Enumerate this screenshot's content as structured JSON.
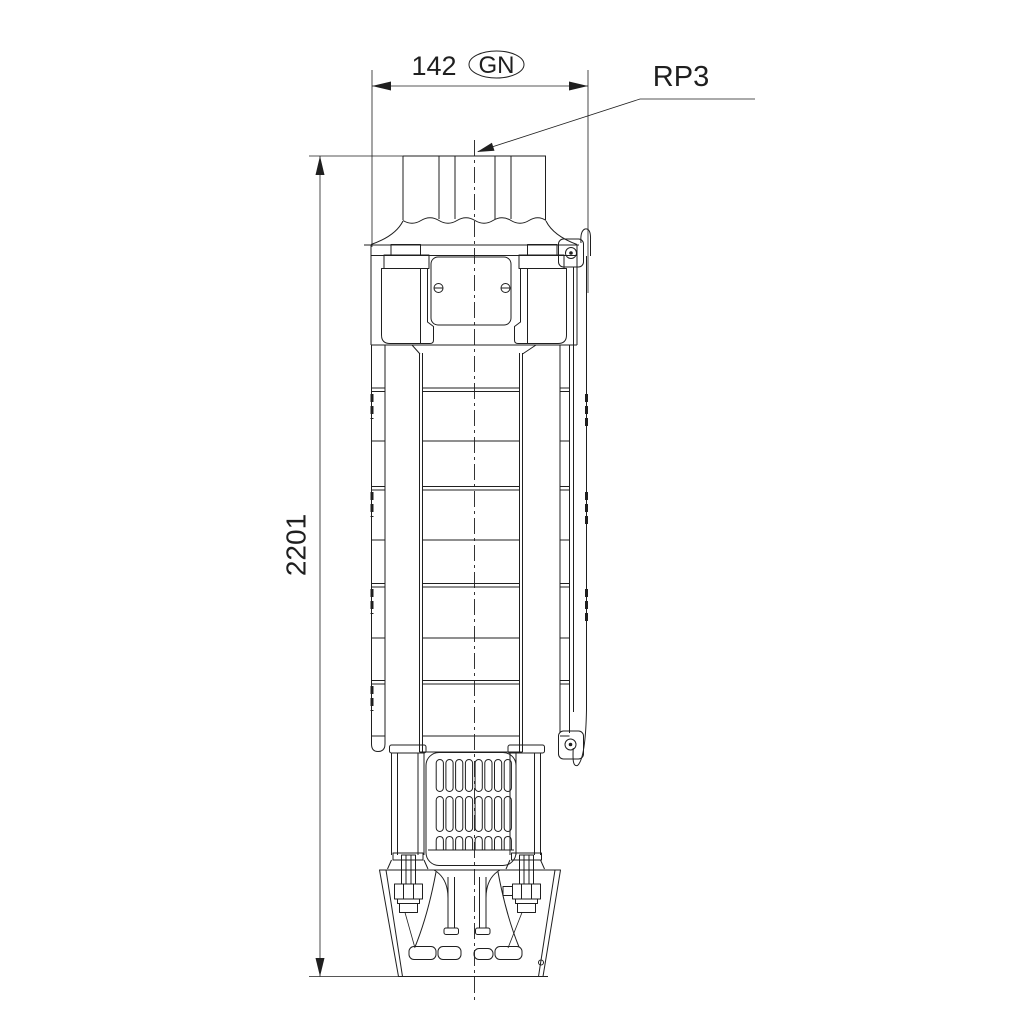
{
  "page": {
    "background": "#ffffff",
    "line_color": "#1f1f1f"
  },
  "dimensions": {
    "width": {
      "value": "142",
      "badge": "GN"
    },
    "height": {
      "value": "2201"
    },
    "connection": "RP3"
  }
}
